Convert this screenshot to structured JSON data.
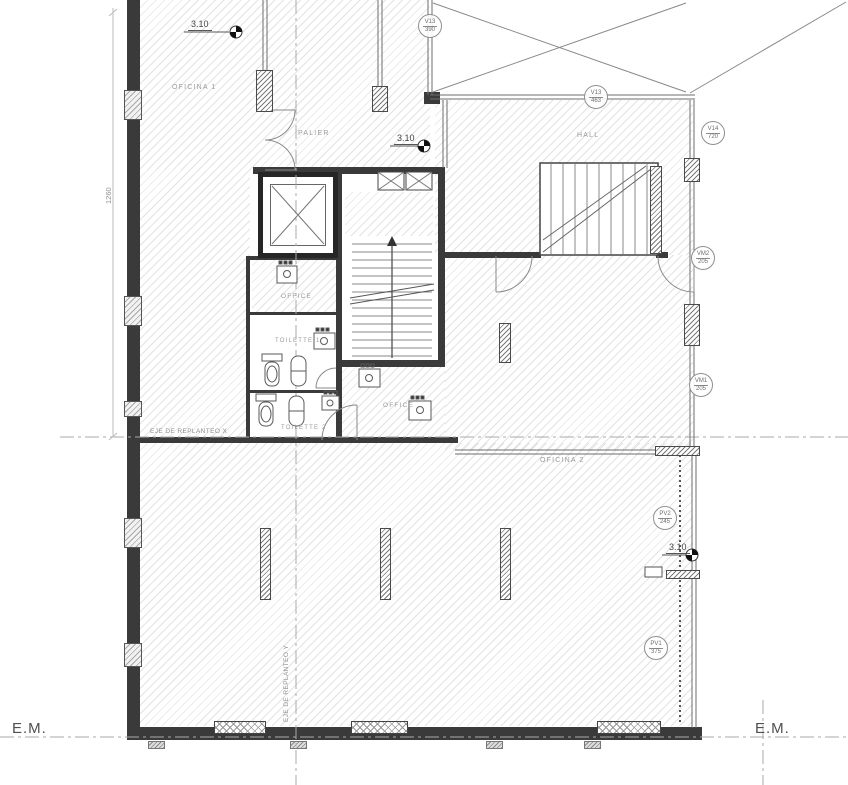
{
  "labels": {
    "oficina1": "OFICINA 1",
    "palier": "PALIER",
    "hall": "HALL",
    "office_kitchen": "OFFICE",
    "toilette1": "TOILETTE 1",
    "toilette2": "TOILETTE 2",
    "office2": "OFFICE",
    "oficina2": "OFICINA 2",
    "axis_x": "EJE DE REPLANTEO X",
    "axis_y": "EJE DE REPLANTEO Y",
    "em_left": "E.M.",
    "em_right": "E.M.",
    "dim_left": "1260"
  },
  "levels": {
    "l1": "3.10",
    "l2": "3.10",
    "l3": "3.10"
  },
  "tags": [
    {
      "code": "V13",
      "num": "390"
    },
    {
      "code": "V13",
      "num": "463"
    },
    {
      "code": "V14",
      "num": "720"
    },
    {
      "code": "VM2",
      "num": "205"
    },
    {
      "code": "VM1",
      "num": "205"
    },
    {
      "code": "PV2",
      "num": "245"
    },
    {
      "code": "PV1",
      "num": "375"
    }
  ],
  "colors": {
    "wall": "#3a3a3a",
    "line": "#777777",
    "hatch": "#e3e3e3",
    "text": "#8f8f8f"
  }
}
